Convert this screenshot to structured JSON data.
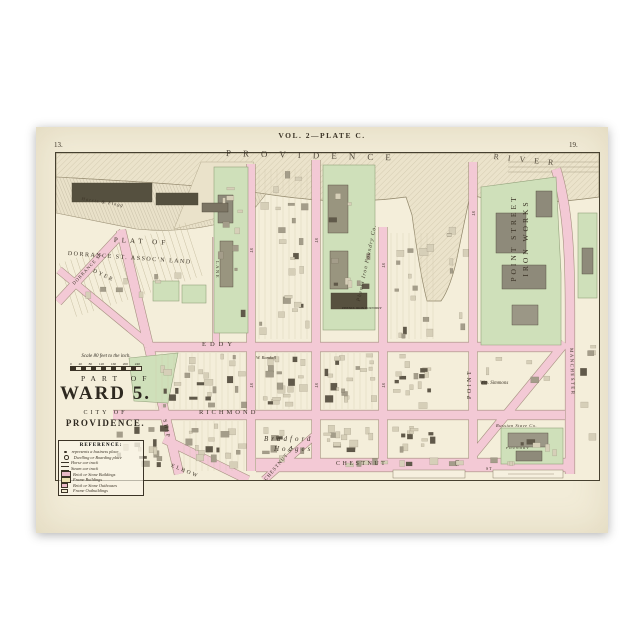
{
  "poster": {
    "page_number_left": "13.",
    "page_number_right": "19.",
    "plate_title": "VOL. 2—PLATE C."
  },
  "river": {
    "word_providence": "PROVIDENCE",
    "word_river": "RIVER"
  },
  "plat": {
    "line1": "PLAT OF",
    "line2": "DORRANCE ST. ASSOC'N LAND"
  },
  "title_block": {
    "part_of": "PART OF",
    "ward": "WARD 5.",
    "city_of": "CITY OF",
    "city_name": "PROVIDENCE.",
    "scale_text": "Scale 80 feet to the inch.",
    "scale_ticks": [
      "0",
      "40",
      "80",
      "120",
      "160",
      "200",
      "240"
    ]
  },
  "legend": {
    "header": "REFERENCE:",
    "rows": [
      {
        "swatch": "dot",
        "label": "represents a business place"
      },
      {
        "swatch": "dot2",
        "label": "Dwelling or Boarding place"
      },
      {
        "swatch": "line",
        "label": "Horse car track"
      },
      {
        "swatch": "line2",
        "label": "Steam car track"
      },
      {
        "swatch": "brick",
        "label": "Brick or Stone Buildings"
      },
      {
        "swatch": "frame",
        "label": "Frame Buildings"
      },
      {
        "swatch": "brickout",
        "label": "Brick or Stone Outhouses"
      },
      {
        "swatch": "frameout",
        "label": "Frame Outbuildings"
      }
    ]
  },
  "streets": {
    "eddy": "EDDY",
    "richmond": "RICHMOND",
    "chestnut": "CHESTNUT",
    "chestnut_st": "CHESTNUT ST",
    "elbow": "ELBOW",
    "ship": "SHIP",
    "dyer": "DYER",
    "dorrance": "DORRANCE ST",
    "lane": "LANE",
    "point": "POINT",
    "manchester": "MANCHESTER",
    "st_abbrev": "ST"
  },
  "landmarks": {
    "iron_works_line1": "POINT STREET",
    "iron_works_line2": "IRON WORKS",
    "phenix_italic": "Phenix Iron Foundry Co.",
    "phenix_caps": "PHENIX IRON FOUNDRY",
    "randall": "W. Randall",
    "hodges_line1": "Bradford",
    "hodges_line2": "Hodges",
    "simmons": "Wm. Simmons",
    "stave": "Russian Stave Co.",
    "foundry": "FOUNDRY",
    "wharf_owner": "Harris & Flagg"
  },
  "colors": {
    "paper": "#f2ecd8",
    "map_paper": "#f4eeda",
    "street_pink": "#f3c9d5",
    "block_green": "#cfe0ba",
    "ink": "#3b3326"
  }
}
